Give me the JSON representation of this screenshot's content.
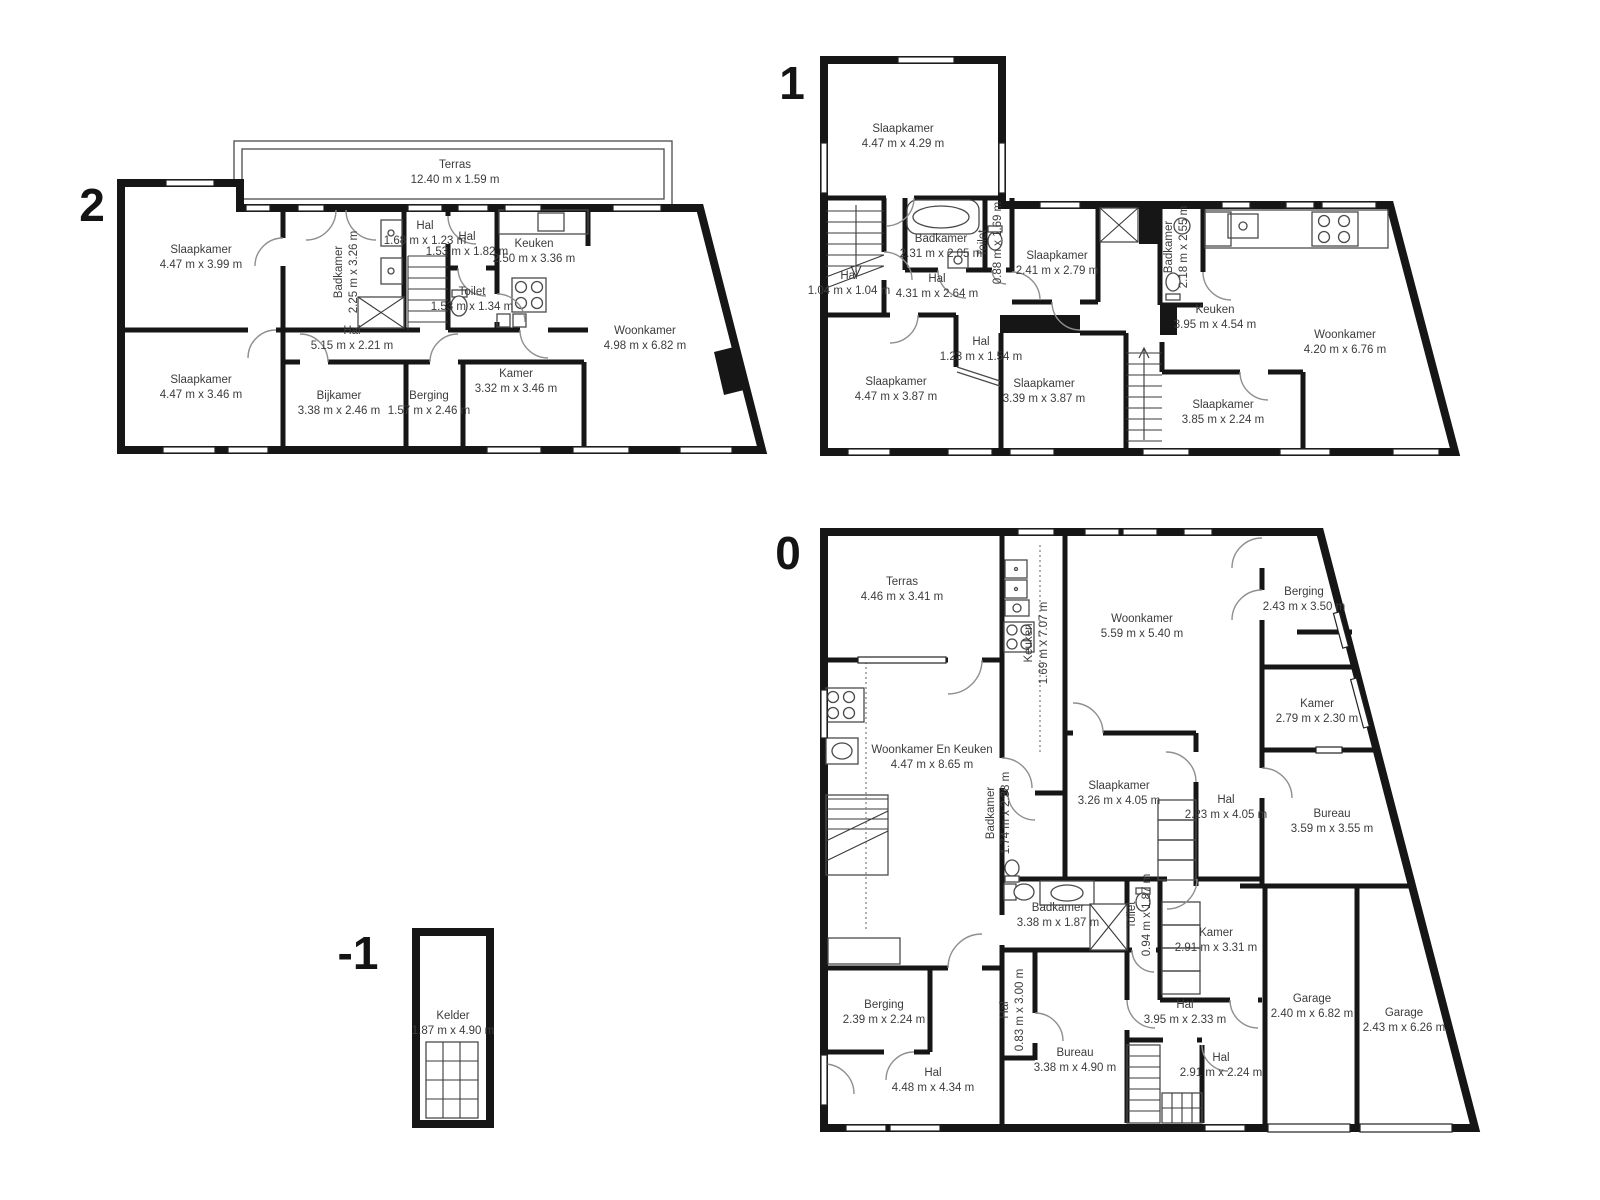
{
  "colors": {
    "walls": "#161616",
    "label_text": "#3c3c3c",
    "background": "#ffffff"
  },
  "floors": [
    {
      "number": "2",
      "rooms": [
        {
          "name": "Terras",
          "dims": "12.40 m x 1.59 m"
        },
        {
          "name": "Slaapkamer",
          "dims": "4.47 m x 3.99 m"
        },
        {
          "name": "Badkamer",
          "dims": "2.25 m x 3.26 m"
        },
        {
          "name": "Hal",
          "dims": "1.68 m x 1.23 m"
        },
        {
          "name": "Hal",
          "dims": "1.53 m x 1.82 m"
        },
        {
          "name": "Keuken",
          "dims": "2.50 m x 3.36 m"
        },
        {
          "name": "Toilet",
          "dims": "1.53 m x 1.34 m"
        },
        {
          "name": "Hal",
          "dims": "5.15 m x 2.21 m"
        },
        {
          "name": "Woonkamer",
          "dims": "4.98 m x 6.82 m"
        },
        {
          "name": "Slaapkamer",
          "dims": "4.47 m x 3.46 m"
        },
        {
          "name": "Bijkamer",
          "dims": "3.38 m x 2.46 m"
        },
        {
          "name": "Berging",
          "dims": "1.57 m x 2.46 m"
        },
        {
          "name": "Kamer",
          "dims": "3.32 m x 3.46 m"
        }
      ]
    },
    {
      "number": "1",
      "rooms": [
        {
          "name": "Slaapkamer",
          "dims": "4.47 m x 4.29 m"
        },
        {
          "name": "Badkamer",
          "dims": "2.31 m x 2.05 m"
        },
        {
          "name": "Toilet",
          "dims": "0.88 m x 1.69 m"
        },
        {
          "name": "Slaapkamer",
          "dims": "2.41 m x 2.79 m"
        },
        {
          "name": "Hal",
          "dims": "1.04 m x 1.04 m"
        },
        {
          "name": "Hal",
          "dims": "4.31 m x 2.64 m"
        },
        {
          "name": "Badkamer",
          "dims": "2.18 m x 2.55 m"
        },
        {
          "name": "Keuken",
          "dims": "3.95 m x 4.54 m"
        },
        {
          "name": "Woonkamer",
          "dims": "4.20 m x 6.76 m"
        },
        {
          "name": "Hal",
          "dims": "1.23 m x 1.54 m"
        },
        {
          "name": "Slaapkamer",
          "dims": "4.47 m x 3.87 m"
        },
        {
          "name": "Slaapkamer",
          "dims": "3.39 m x 3.87 m"
        },
        {
          "name": "Slaapkamer",
          "dims": "3.85 m x 2.24 m"
        }
      ]
    },
    {
      "number": "0",
      "rooms": [
        {
          "name": "Terras",
          "dims": "4.46 m x 3.41 m"
        },
        {
          "name": "Keuken",
          "dims": "1.69 m x 7.07 m"
        },
        {
          "name": "Woonkamer",
          "dims": "5.59 m x 5.40 m"
        },
        {
          "name": "Berging",
          "dims": "2.43 m x 3.50 m"
        },
        {
          "name": "Kamer",
          "dims": "2.79 m x 2.30 m"
        },
        {
          "name": "Woonkamer En Keuken",
          "dims": "4.47 m x 8.65 m"
        },
        {
          "name": "Badkamer",
          "dims": "1.74 m x 2.38 m"
        },
        {
          "name": "Slaapkamer",
          "dims": "3.26 m x 4.05 m"
        },
        {
          "name": "Hal",
          "dims": "2.23 m x 4.05 m"
        },
        {
          "name": "Bureau",
          "dims": "3.59 m x 3.55 m"
        },
        {
          "name": "Badkamer",
          "dims": "3.38 m x 1.87 m"
        },
        {
          "name": "Toilet",
          "dims": "0.94 m x 1.87 m"
        },
        {
          "name": "Kamer",
          "dims": "2.91 m x 3.31 m"
        },
        {
          "name": "Berging",
          "dims": "2.39 m x 2.24 m"
        },
        {
          "name": "Hal",
          "dims": "0.83 m x 3.00 m"
        },
        {
          "name": "Hal",
          "dims": "3.95 m x 2.33 m"
        },
        {
          "name": "Garage",
          "dims": "2.40 m x 6.82 m"
        },
        {
          "name": "Garage",
          "dims": "2.43 m x 6.26 m"
        },
        {
          "name": "Hal",
          "dims": "2.91 m x 2.24 m"
        },
        {
          "name": "Bureau",
          "dims": "3.38 m x 4.90 m"
        },
        {
          "name": "Hal",
          "dims": "4.48 m x 4.34 m"
        }
      ]
    },
    {
      "number": "-1",
      "rooms": [
        {
          "name": "Kelder",
          "dims": "1.87 m x 4.90 m"
        }
      ]
    }
  ]
}
